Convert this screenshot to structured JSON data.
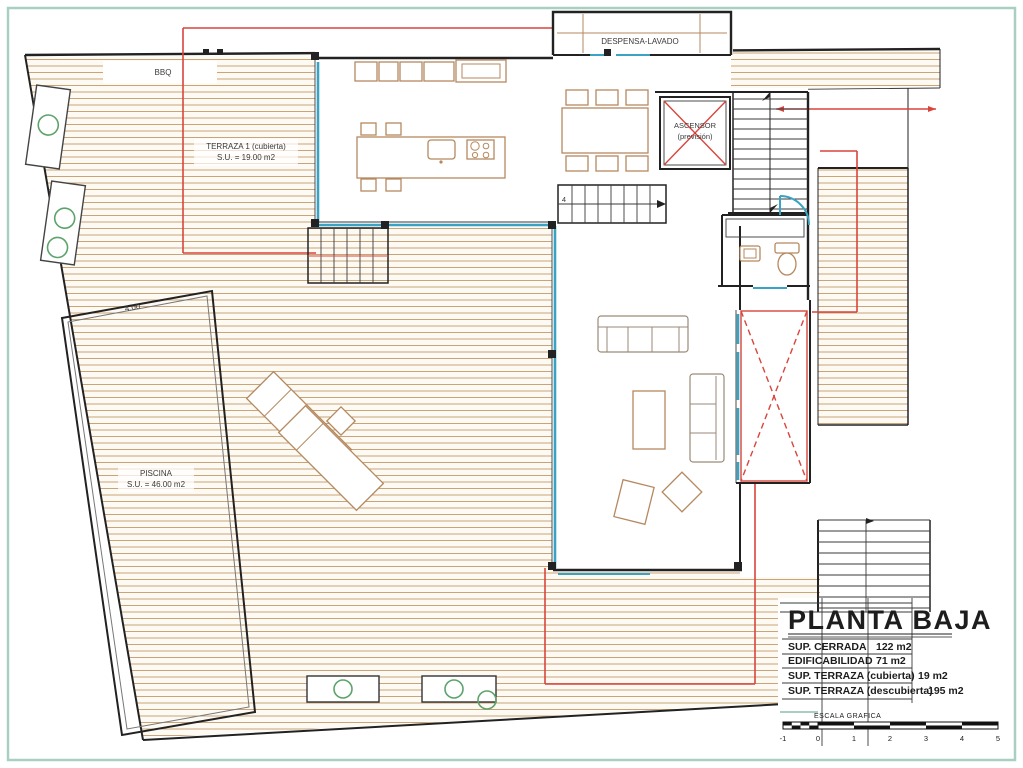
{
  "labels": {
    "bbq": "BBQ",
    "despensa": "DESPENSA-LAVADO",
    "ascensor": {
      "line1": "ASCENSOR",
      "line2": "(previsión)"
    },
    "terraza1": {
      "line1": "TERRAZA 1 (cubierta)",
      "line2": "S.U. = 19.00 m2"
    },
    "piscina": {
      "line1": "PISCINA",
      "line2": "S.U. = 46.00 m2"
    },
    "pool_width_dim": "4.00",
    "stair_mark": "4"
  },
  "title_block": {
    "title": "PLANTA BAJA",
    "rows": [
      {
        "label": "SUP. CERRADA",
        "value": "122 m2"
      },
      {
        "label": "EDIFICABILIDAD",
        "value": "71 m2"
      },
      {
        "label": "SUP. TERRAZA (cubierta)",
        "value": "19 m2"
      },
      {
        "label": "SUP. TERRAZA (descubierta)",
        "value": "195 m2"
      }
    ],
    "scale_label": "ESCALA GRAFICA",
    "scale_ticks": [
      "-1",
      "0",
      "1",
      "2",
      "3",
      "4",
      "5"
    ]
  },
  "colors": {
    "wall": "#222222",
    "glass": "#3aa3c4",
    "red": "#d9453c",
    "furn": "#b5895f",
    "green": "#5da36b",
    "frame": "#a8cfc0",
    "deck": "#c8a478",
    "deckbg": "#fdfaf4",
    "pool_fill": "#edf4f0",
    "pool_hatch": "#aecdc5",
    "text": "#3a3a3a"
  }
}
